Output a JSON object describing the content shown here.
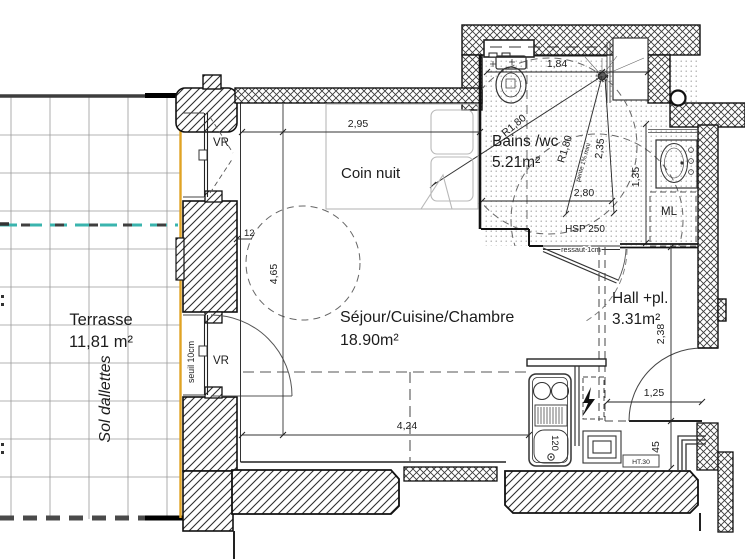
{
  "rooms": {
    "terrasse": {
      "name": "Terrasse",
      "area": "11,81 m²",
      "floor_note": "Sol dallettes"
    },
    "coin_nuit": {
      "name": "Coin nuit"
    },
    "sejour": {
      "name": "Séjour/Cuisine/Chambre",
      "area": "18.90m²"
    },
    "bains": {
      "name": "Bains /wc",
      "area": "5.21m²"
    },
    "hall": {
      "name": "Hall +pl.",
      "area": "3.31m²"
    }
  },
  "dimensions": {
    "coin_nuit_width": "2,95",
    "pier_offset": "12",
    "sejour_depth": "4,65",
    "sejour_width": "4,24",
    "bains_width": "1,84",
    "bains_depth": "2,35",
    "bains_diag": "2,80",
    "basin_bay": "1,35",
    "hall_depth": "2,38",
    "hall_width": "1,25",
    "entry_niche": "45",
    "kitchen_unit": "120"
  },
  "annotations": {
    "vr_upper": "VR",
    "vr_lower": "VR",
    "seuil": "seuil 10cm",
    "hsp": "HSP 250",
    "ressaut": "ressaut 1cm",
    "ml": "ML",
    "ht30": "HT.30",
    "pente": "pente 1% mini",
    "radius_a": "R1,80",
    "radius_b": "R1,80"
  },
  "colors": {
    "facade_line": "#e0a425",
    "water_line": "#3ab4ae",
    "ink": "#1c1c1c",
    "grid": "#9a9a9a",
    "light": "#b8b8b8"
  }
}
